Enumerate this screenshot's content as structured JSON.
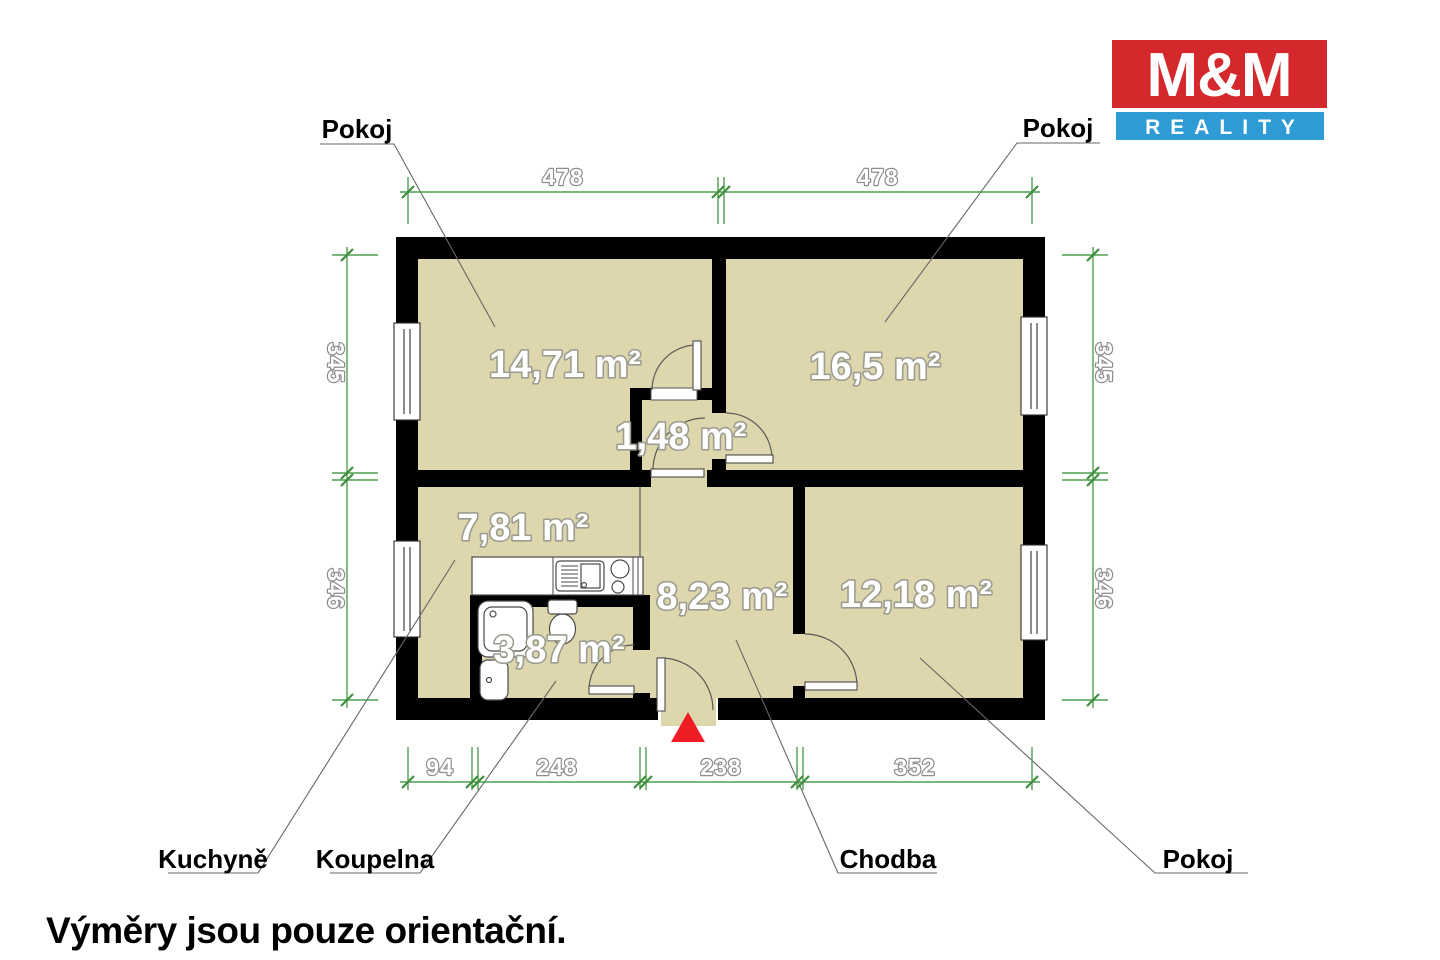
{
  "logo": {
    "title": "M&M",
    "subtitle": "REALITY"
  },
  "disclaimer": "Výměry jsou pouze orientační.",
  "callouts": {
    "room_top_left": "Pokoj",
    "room_top_right": "Pokoj",
    "kitchen": "Kuchyně",
    "bathroom": "Koupelna",
    "hallway": "Chodba",
    "room_bottom_right": "Pokoj"
  },
  "areas": {
    "room_top_left": "14,71 m²",
    "room_top_right": "16,5 m²",
    "closet": "1,48 m²",
    "kitchen": "7,81 m²",
    "bathroom": "3,87 m²",
    "hallway": "8,23 m²",
    "room_bottom_right": "12,18 m²"
  },
  "dimensions": {
    "top": [
      "478",
      "478"
    ],
    "bottom": [
      "94",
      "248",
      "238",
      "352"
    ],
    "left": [
      "345",
      "346"
    ],
    "right": [
      "345",
      "346"
    ]
  },
  "colors": {
    "floor": "#ded7ad",
    "wall": "#000000",
    "dimension_green": "#4f9f4f",
    "logo_red": "#d5282d",
    "logo_blue": "#2f9bd5",
    "entrance_arrow_red": "#ee1c23"
  }
}
